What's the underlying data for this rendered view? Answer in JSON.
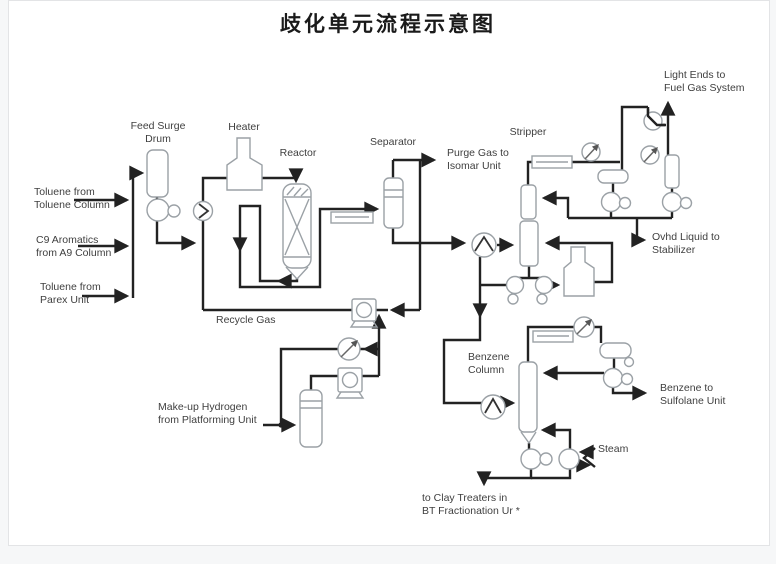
{
  "title": "歧化单元流程示意图",
  "colors": {
    "background": "#f6f7f8",
    "panel": "#ffffff",
    "panel_border": "#e3e4e6",
    "pipe": "#222222",
    "equipment_outline": "#9ba1a6",
    "label_text": "#3f3f3f",
    "title_text": "#1a1a1a"
  },
  "labels": {
    "toluene_toluene_column": {
      "text": "Toluene from\nToluene Column"
    },
    "c9_aromatics": {
      "text": "C9 Aromatics\nfrom A9 Column"
    },
    "toluene_parex": {
      "text": "Toluene from\nParex Unit"
    },
    "feed_surge_drum": {
      "text": "Feed Surge\nDrum"
    },
    "heater": {
      "text": "Heater"
    },
    "reactor": {
      "text": "Reactor"
    },
    "separator": {
      "text": "Separator"
    },
    "purge_gas": {
      "text": "Purge Gas to\nIsomar Unit"
    },
    "stripper": {
      "text": "Stripper"
    },
    "light_ends": {
      "text": "Light Ends to\nFuel Gas System"
    },
    "ovhd_liquid": {
      "text": "Ovhd Liquid to\nStabilizer"
    },
    "recycle_gas": {
      "text": "Recycle Gas"
    },
    "benzene_column": {
      "text": "Benzene\nColumn"
    },
    "benzene_product": {
      "text": "Benzene to\nSulfolane Unit"
    },
    "steam": {
      "text": "Steam"
    },
    "makeup_hydrogen": {
      "text": "Make-up Hydrogen\nfrom Platforming Unit"
    },
    "clay_treaters": {
      "text": "to Clay Treaters in\nBT Fractionation Ur *"
    }
  },
  "equipment_symbols": [
    "feed-surge-drum-vessel",
    "feed-pump",
    "mixing-valve",
    "heater-furnace",
    "reactor-vessel",
    "feed-effluent-exchanger",
    "separator-vessel",
    "recycle-compressor",
    "makeup-compressor",
    "makeup-ko-drum",
    "flow-instrument",
    "stripper-column",
    "stripper-condenser",
    "stripper-reflux-drum",
    "fuel-gas-ko-pot",
    "light-ends-valve",
    "ovhd-pumps",
    "stripper-bottoms-pumps",
    "stripper-reboiler",
    "benzene-column-vessel",
    "benzene-condenser",
    "benzene-reflux-drum",
    "benzene-reflux-pump",
    "benzene-feed-valve",
    "benzene-bottoms-pump",
    "steam-reboiler"
  ]
}
